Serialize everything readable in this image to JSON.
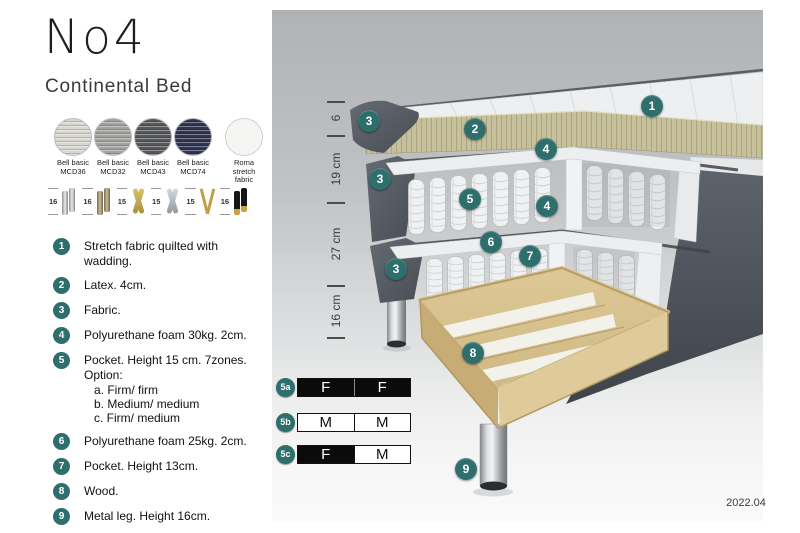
{
  "header": {
    "title": "No4",
    "subtitle": "Continental Bed"
  },
  "colors": {
    "accent_teal": "#2e6e6c",
    "firmness_dark": "#0b0b0b",
    "firmness_light": "#ffffff"
  },
  "swatches": {
    "items": [
      {
        "name": "Bell basic",
        "code": "MCD36",
        "color": "#d8d7d2"
      },
      {
        "name": "Bell basic",
        "code": "MCD32",
        "color": "#a2a2a0"
      },
      {
        "name": "Bell basic",
        "code": "MCD43",
        "color": "#56585c"
      },
      {
        "name": "Bell basic",
        "code": "MCD74",
        "color": "#2f3450"
      },
      {
        "name": "Roma",
        "code": "stretch fabric",
        "color": "#f5f5f3"
      }
    ]
  },
  "legs": {
    "items": [
      {
        "height": "16",
        "style": "cylinder-silver"
      },
      {
        "height": "16",
        "style": "cylinder-bronze"
      },
      {
        "height": "15",
        "style": "twist-gold"
      },
      {
        "height": "15",
        "style": "twist-silver"
      },
      {
        "height": "15",
        "style": "hairpin-gold"
      },
      {
        "height": "16",
        "style": "cylinder-black-gold"
      }
    ]
  },
  "features": {
    "items": [
      {
        "num": "1",
        "text": "Stretch fabric quilted with wadding."
      },
      {
        "num": "2",
        "text": "Latex. 4cm."
      },
      {
        "num": "3",
        "text": "Fabric."
      },
      {
        "num": "4",
        "text": "Polyurethane foam 30kg. 2cm."
      },
      {
        "num": "5",
        "text": "Pocket. Height 15 cm. 7zones. Option:",
        "sub": [
          "a. Firm/ firm",
          "b. Medium/ medium",
          "c. Firm/ medium"
        ]
      },
      {
        "num": "6",
        "text": "Polyurethane foam 25kg. 2cm."
      },
      {
        "num": "7",
        "text": "Pocket. Height 13cm."
      },
      {
        "num": "8",
        "text": "Wood."
      },
      {
        "num": "9",
        "text": "Metal leg. Height 16cm."
      }
    ]
  },
  "diagram": {
    "callouts": [
      {
        "num": "1",
        "x": 652,
        "y": 106
      },
      {
        "num": "2",
        "x": 475,
        "y": 129
      },
      {
        "num": "3",
        "x": 369,
        "y": 121
      },
      {
        "num": "3",
        "x": 380,
        "y": 179
      },
      {
        "num": "3",
        "x": 396,
        "y": 269
      },
      {
        "num": "4",
        "x": 546,
        "y": 149
      },
      {
        "num": "4",
        "x": 547,
        "y": 206
      },
      {
        "num": "5",
        "x": 470,
        "y": 199
      },
      {
        "num": "6",
        "x": 491,
        "y": 242
      },
      {
        "num": "7",
        "x": 530,
        "y": 256
      },
      {
        "num": "8",
        "x": 473,
        "y": 353
      },
      {
        "num": "9",
        "x": 466,
        "y": 469
      }
    ],
    "ruler": {
      "segments": [
        {
          "label": "6",
          "from": 101,
          "to": 135
        },
        {
          "label": "19 cm",
          "from": 135,
          "to": 202
        },
        {
          "label": "27 cm",
          "from": 202,
          "to": 285
        },
        {
          "label": "16 cm",
          "from": 285,
          "to": 337
        }
      ]
    },
    "firmness": {
      "rows": [
        {
          "id": "5a",
          "cells": [
            {
              "label": "F",
              "variant": "dark"
            },
            {
              "label": "F",
              "variant": "dark"
            }
          ]
        },
        {
          "id": "5b",
          "cells": [
            {
              "label": "M",
              "variant": "light"
            },
            {
              "label": "M",
              "variant": "light"
            }
          ]
        },
        {
          "id": "5c",
          "cells": [
            {
              "label": "F",
              "variant": "dark"
            },
            {
              "label": "M",
              "variant": "light"
            }
          ]
        }
      ]
    },
    "version": "2022.04"
  }
}
